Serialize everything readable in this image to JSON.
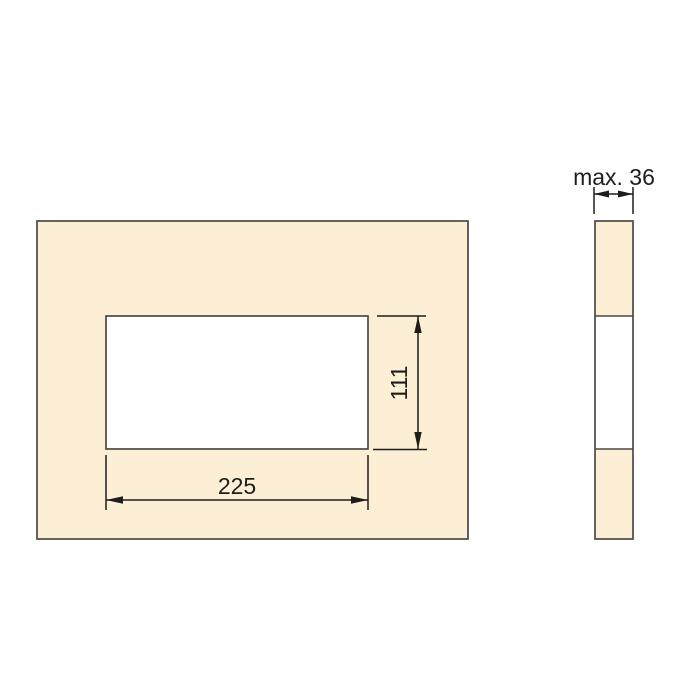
{
  "labels": {
    "cutout_width": "225",
    "cutout_height": "111",
    "thickness": "max. 36"
  },
  "colors": {
    "panel_fill": "#FCEFD5",
    "cutout_fill": "#FFFFFF",
    "outline": "#4A4A45",
    "dimension": "#1D1D1B",
    "background": "#FFFFFF"
  }
}
